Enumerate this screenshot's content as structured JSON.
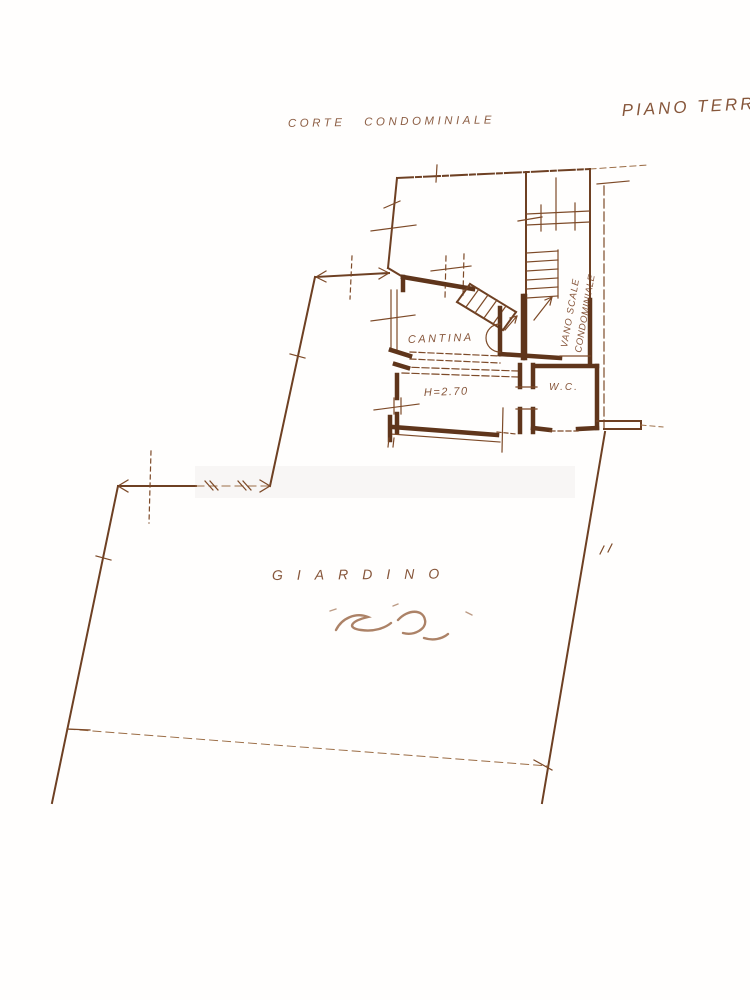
{
  "page": {
    "background": "#fffefd",
    "ink_color": "#6e4023",
    "text_color": "#7a4426"
  },
  "header": {
    "left_label": "CORTE CONDOMINIALE",
    "right_label": "PIANO TERRA"
  },
  "floorplan": {
    "rooms": {
      "cantina_label": "CANTINA",
      "ceiling_height_label": "H=2.70",
      "wc_label": "W.C.",
      "stairwell_label_line1": "VANO SCALE",
      "stairwell_label_line2": "CONDOMINIALE"
    },
    "garden_label": "GIARDINO"
  }
}
